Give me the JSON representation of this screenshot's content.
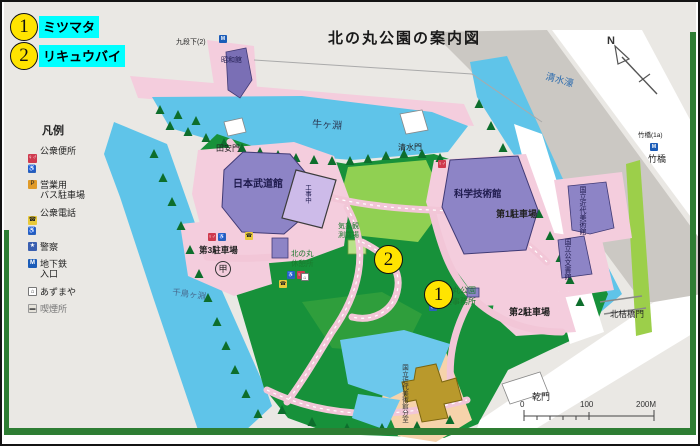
{
  "title": "北の丸公園の案内図",
  "callouts": [
    {
      "number": "1",
      "label": "ミツマタ"
    },
    {
      "number": "2",
      "label": "リキュウバイ"
    }
  ],
  "legend": {
    "title": "凡例",
    "items": [
      {
        "id": "public-toilet",
        "label": "公衆便所",
        "icon": "♀♂",
        "accessible_icon": "♿"
      },
      {
        "id": "bus-parking",
        "label": "営業用\nバス駐車場",
        "icon": "P",
        "accessible_icon": ""
      },
      {
        "id": "public-phone",
        "label": "公衆電話",
        "icon": "☎",
        "accessible_icon": "♿"
      },
      {
        "id": "police",
        "label": "警察",
        "icon": "★",
        "accessible_icon": ""
      },
      {
        "id": "subway-entrance",
        "label": "地下鉄\n入口",
        "icon": "M",
        "accessible_icon": ""
      },
      {
        "id": "azumaya",
        "label": "あずまや",
        "icon": "⌂",
        "accessible_icon": ""
      },
      {
        "id": "smoking-area",
        "label": "喫煙所",
        "icon": "▬",
        "accessible_icon": ""
      }
    ]
  },
  "map_labels": {
    "kudanshita": "九段下(2)",
    "showakan": "昭和館",
    "ushigafuchi": "牛ヶ淵",
    "shimizubori": "清水濠",
    "takebashi_exit": "竹橋(1a)",
    "takebashi": "竹橋",
    "tayasumon": "田安門",
    "budokan": "日本武道館",
    "shimizumon": "清水門",
    "science_museum": "科学技術館",
    "parking1": "第1駐車場",
    "parking2": "第2駐車場",
    "parking3": "第3駐車場",
    "parking3_symbol": "甲",
    "weather_station": "気象観\n測露場",
    "rest_house": "北の丸\n休憩所",
    "park_office": "北の丸公園\n管理事務所",
    "chidorigafuchi": "千鳥ヶ淵",
    "momat": "国立近代美術館",
    "archives": "国立公文書館",
    "craft_annex": "国立近代美術館分室",
    "construction": "工事中",
    "kitahanebashimon": "北桔橋門",
    "inuimon": "乾門"
  },
  "compass": {
    "label": "N"
  },
  "scale_bar": {
    "ticks": [
      "0",
      "100",
      "200M"
    ]
  },
  "colors": {
    "moat_blue": "#5fc4e9",
    "park_green": "#17913a",
    "lawn_green": "#90d052",
    "road_pink": "#f4cddd",
    "building_purple": "#8d84c6",
    "highlight_cyan": "#00ffff",
    "marker_yellow": "#ffe400",
    "craft_olive": "#b9992c"
  }
}
